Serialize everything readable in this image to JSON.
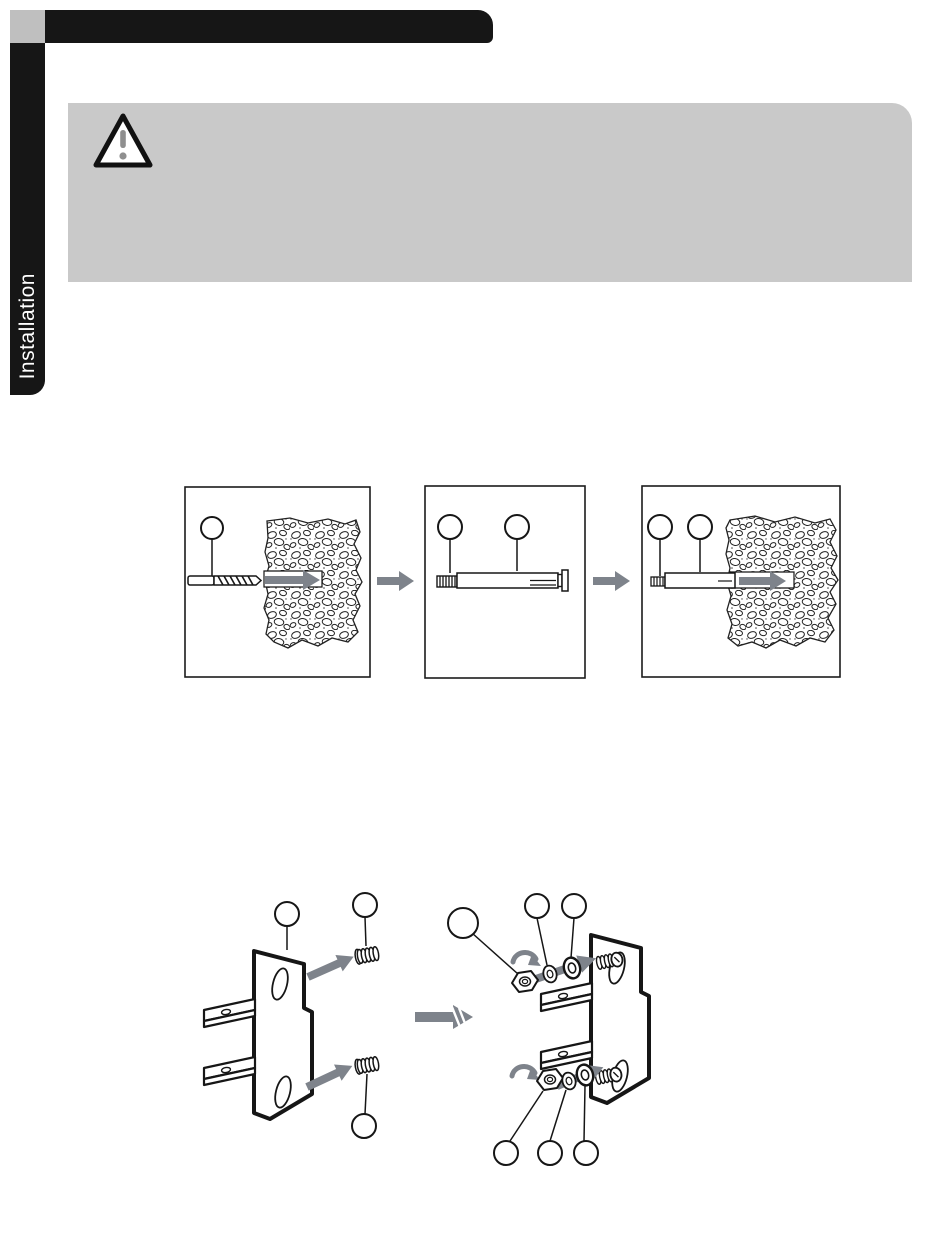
{
  "sidebar": {
    "tab_label": "Installation"
  },
  "icons": {
    "warning": "warning-triangle-icon",
    "step_arrow": "arrow-right-icon",
    "rotate_arrow": "rotate-arrow-icon",
    "callout": "callout-circle"
  },
  "colors": {
    "header_black": "#161616",
    "corner_gray": "#bfbfbf",
    "warning_panel_gray": "#c9c9c9",
    "diagram_arrow_gray": "#7e838b",
    "line_art_black": "#1c1c1c",
    "warning_mark_gray": "#8f8f8f"
  }
}
